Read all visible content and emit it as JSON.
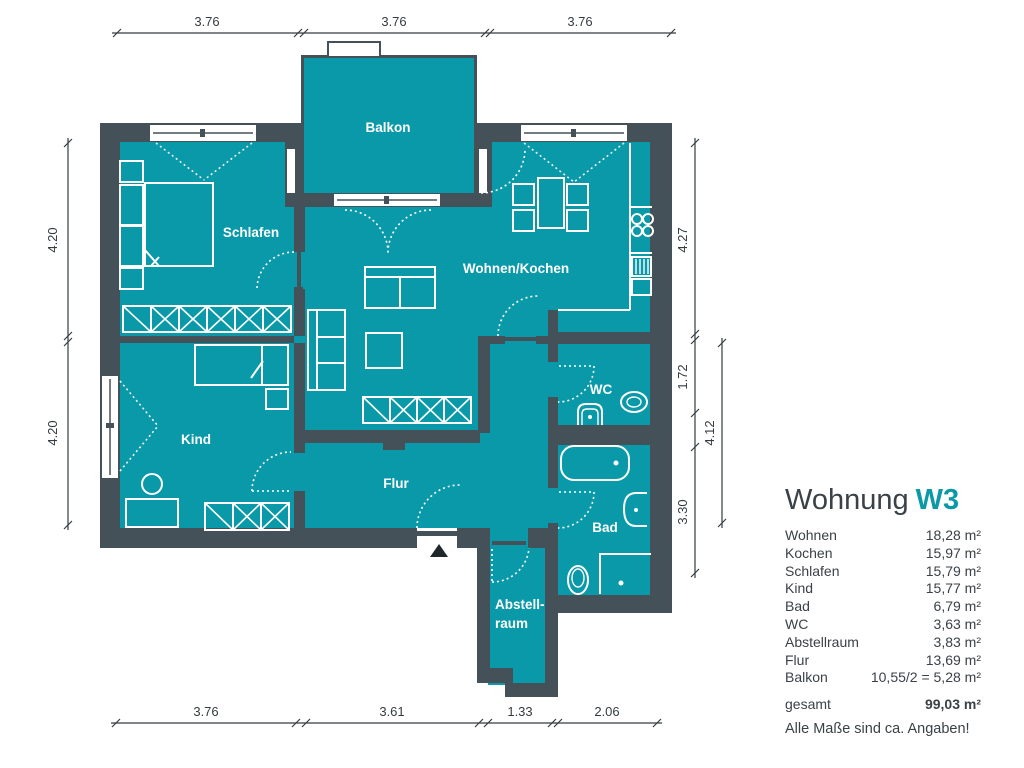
{
  "colors": {
    "room_fill": "#0999a8",
    "wall": "#455158",
    "accent": "#0b99a8",
    "text": "#3a4247",
    "entrance_marker": "#20272b"
  },
  "icons": {
    "entrance_marker": "filled-triangle-up"
  },
  "plan": {
    "rooms": {
      "schlafen": "Schlafen",
      "kind": "Kind",
      "wohnen_kochen": "Wohnen/Kochen",
      "balkon": "Balkon",
      "flur": "Flur",
      "wc": "WC",
      "bad": "Bad",
      "abstellraum_line1": "Abstell-",
      "abstellraum_line2": "raum"
    },
    "dimensions": {
      "top": [
        "3.76",
        "3.76",
        "3.76"
      ],
      "bottom": [
        "3.76",
        "3.61",
        "1.33",
        "2.06"
      ],
      "left": [
        "4.20",
        "4.20"
      ],
      "right": [
        "4.27",
        "1.72",
        "3.30"
      ],
      "right_outer": "4.12"
    }
  },
  "legend": {
    "title_prefix": "Wohnung",
    "title_unit": "W3",
    "rows": [
      {
        "label": "Wohnen",
        "value": "18,28 m²"
      },
      {
        "label": "Kochen",
        "value": "15,97 m²"
      },
      {
        "label": "Schlafen",
        "value": "15,79 m²"
      },
      {
        "label": "Kind",
        "value": "15,77 m²"
      },
      {
        "label": "Bad",
        "value": "6,79 m²"
      },
      {
        "label": "WC",
        "value": "3,63 m²"
      },
      {
        "label": "Abstellraum",
        "value": "3,83 m²"
      },
      {
        "label": "Flur",
        "value": "13,69 m²"
      },
      {
        "label": "Balkon",
        "value": "10,55/2 = 5,28 m²"
      }
    ],
    "total": {
      "label": "gesamt",
      "value": "99,03 m²"
    },
    "note": "Alle Maße sind ca. Angaben!"
  }
}
